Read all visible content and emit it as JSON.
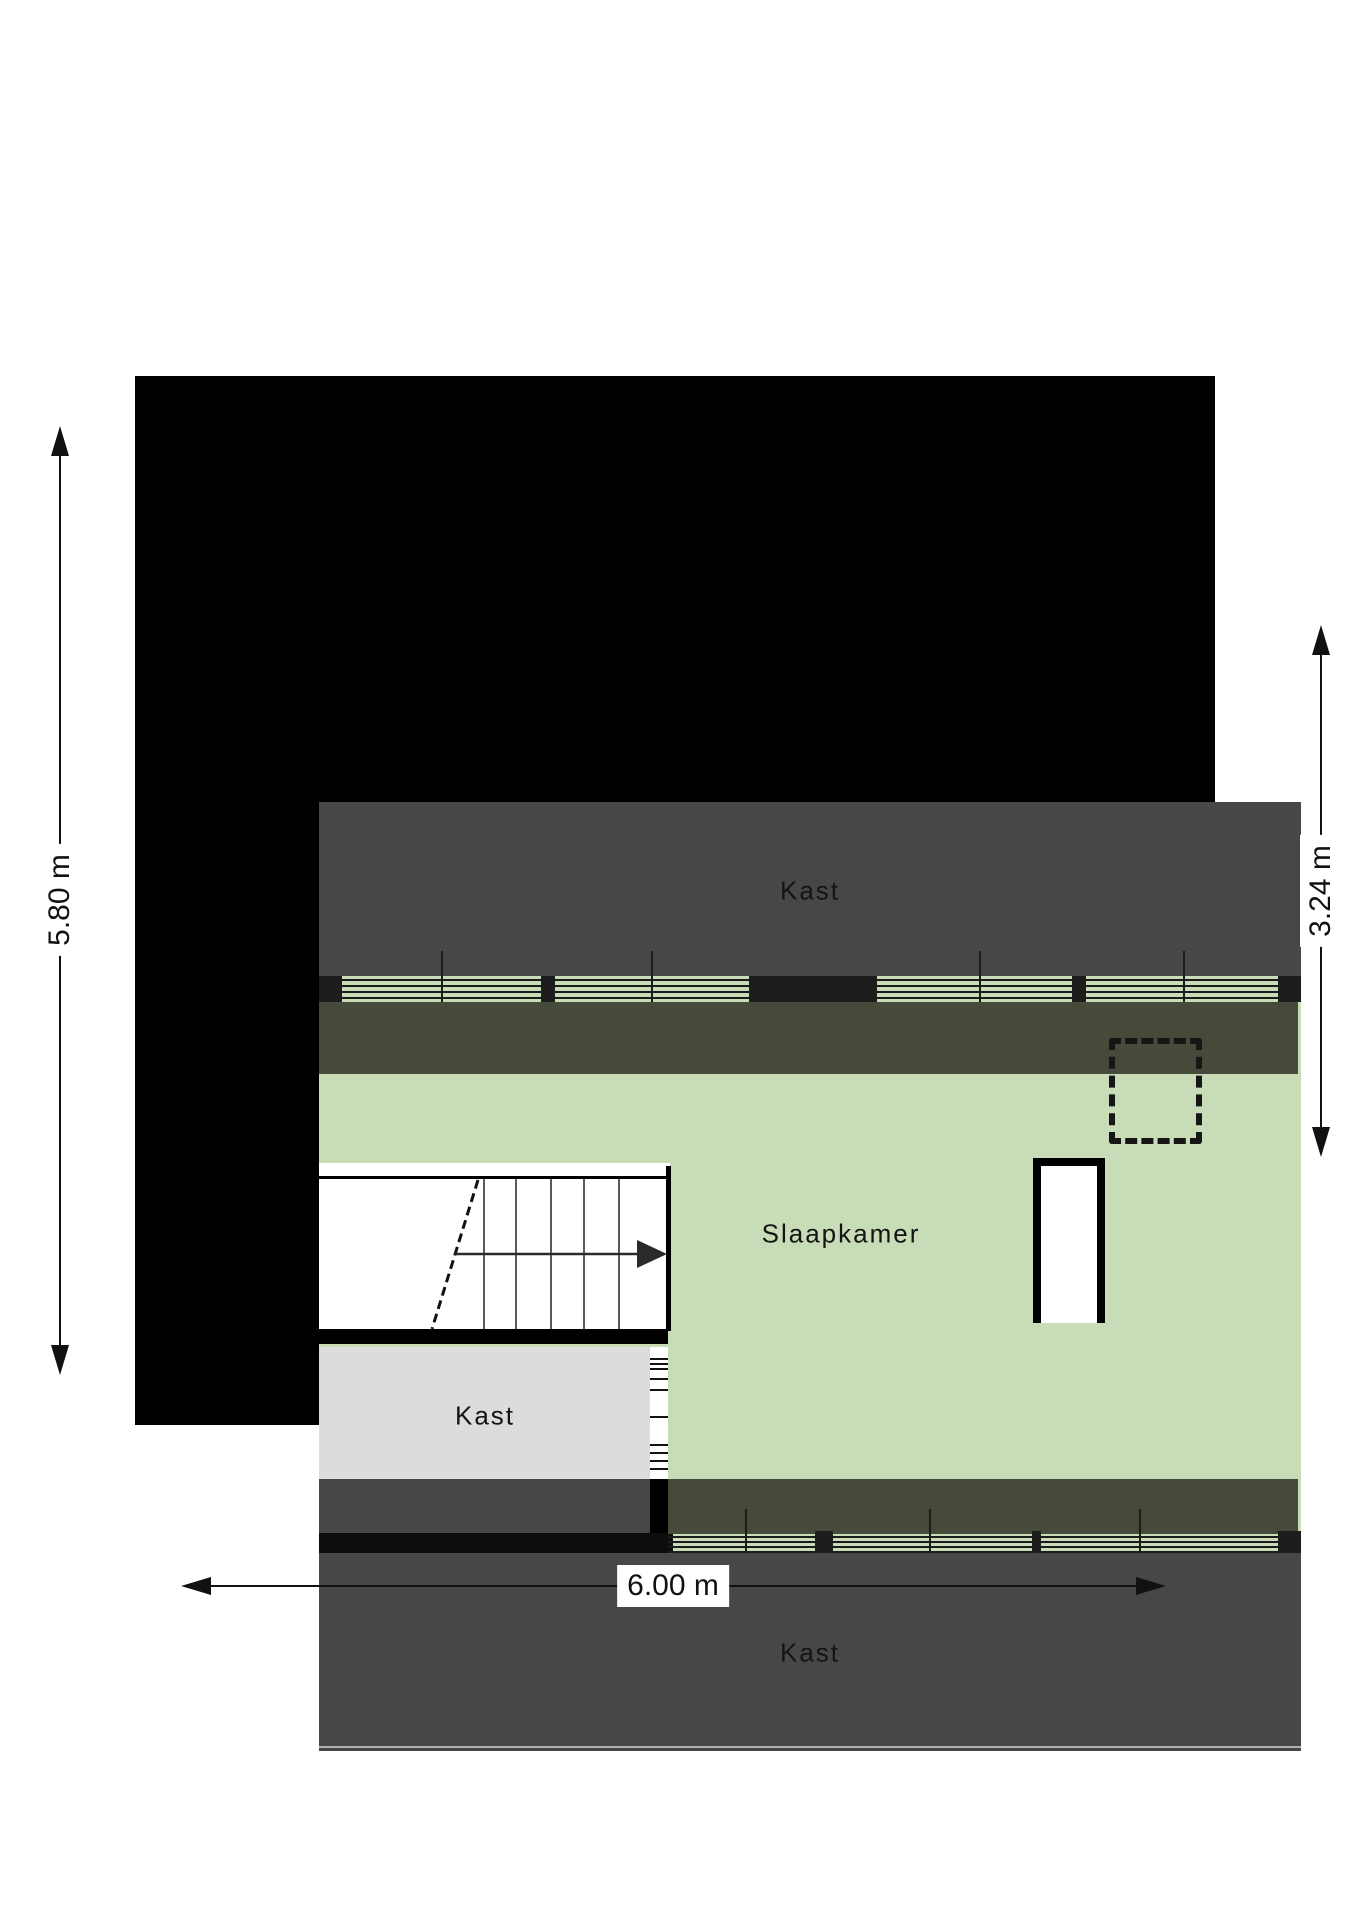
{
  "plan": {
    "title": "floor-plan",
    "rooms": [
      {
        "id": "kast-top",
        "label": "Kast"
      },
      {
        "id": "slaapkamer",
        "label": "Slaapkamer"
      },
      {
        "id": "kast-middle",
        "label": "Kast"
      },
      {
        "id": "kast-bottom",
        "label": "Kast"
      }
    ],
    "dimensions": {
      "left": "5.80 m",
      "right": "3.24 m",
      "bottom": "6.00 m"
    },
    "colors": {
      "wall": "#000000",
      "attic_storage_gray": "#474747",
      "low_roof_band_olive": "#454a3a",
      "bedroom_green": "#c8dcb8",
      "closet_light_gray": "#dcdcdc",
      "page_background": "#ffffff"
    }
  }
}
